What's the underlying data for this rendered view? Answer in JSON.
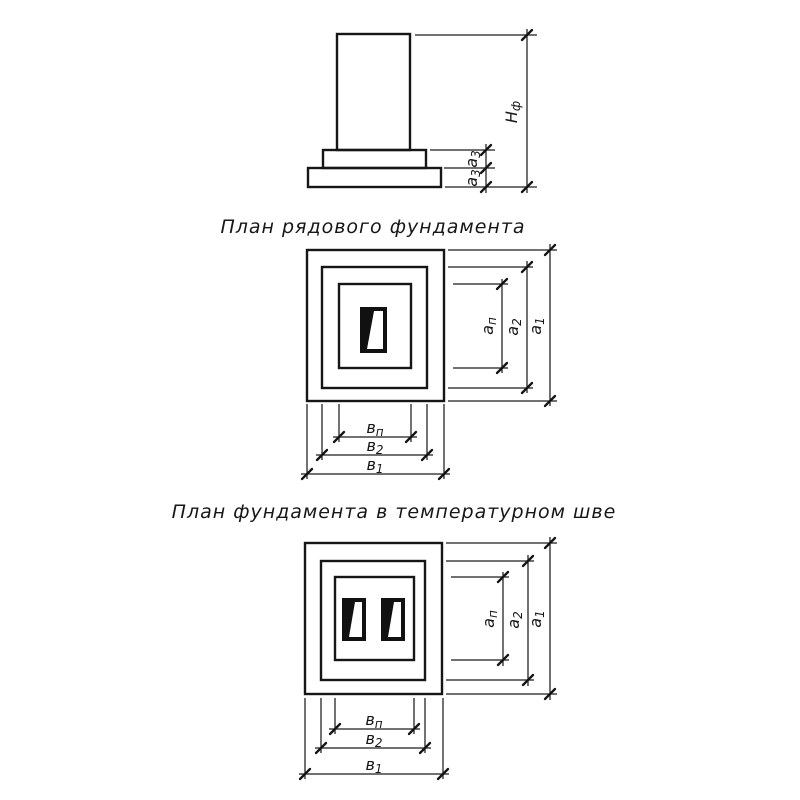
{
  "titles": {
    "plan_row": "План рядового фундамента",
    "plan_joint": "План фундамента в температурном шве"
  },
  "dim_labels": {
    "hf": {
      "base": "Н",
      "sub": "ф"
    },
    "a3a": {
      "base": "а",
      "sub": "3"
    },
    "a3b": {
      "base": "а",
      "sub": "3"
    },
    "an": {
      "base": "а",
      "sub": "п"
    },
    "a2": {
      "base": "а",
      "sub": "2"
    },
    "a1": {
      "base": "а",
      "sub": "1"
    },
    "bn": {
      "base": "в",
      "sub": "п"
    },
    "b2": {
      "base": "в",
      "sub": "2"
    },
    "b1": {
      "base": "в",
      "sub": "1"
    }
  },
  "colors": {
    "ink": "#161616",
    "paper": "#ffffff"
  }
}
